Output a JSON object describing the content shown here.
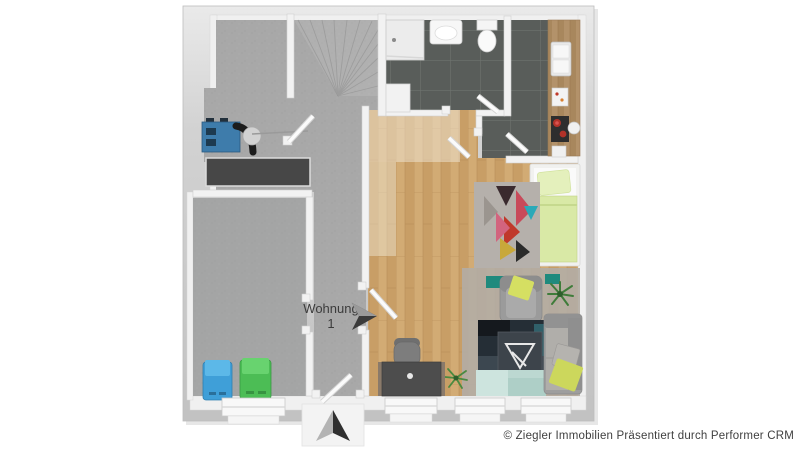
{
  "plan": {
    "unit_label_line1": "Wohnung",
    "unit_label_line2": "1",
    "icons": {
      "north_arrow": "north-arrow-icon",
      "unit_pointer": "unit-direction-arrow-icon"
    }
  },
  "footer": {
    "copyright": "© Ziegler Immobilien Präsentiert durch Performer CRM"
  },
  "colors": {
    "outer_wall": "#cbcbcb",
    "inner_wall": "#f2f2f2",
    "concrete_floor": "#a8a8a8",
    "tile_floor": "#595d5a",
    "tile_grout": "#6e736f",
    "wood_floor": "#cda46c",
    "counter_wood": "#b3926a",
    "bed_green": "#d9e9a6",
    "pillow_yellow": "#ccd75c",
    "sofa_gray": "#9e9e9e",
    "rug_dark": "#252e36",
    "rug_teal": "#bcd8d1",
    "teal_accent": "#1f8a7d",
    "bin_blue": "#3f9fd8",
    "bin_green": "#4cbd55",
    "machine_blue": "#3e7cab",
    "stove_red": "#b23229"
  }
}
